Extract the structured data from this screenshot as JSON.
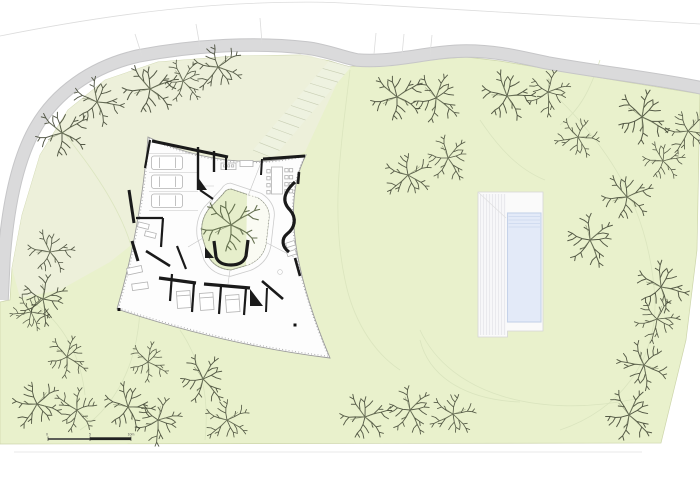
{
  "document": {
    "kind": "site-plan"
  },
  "colors": {
    "background": "#ffffff",
    "site_green": "#e9f1cc",
    "site_green_alt": "#edf0dc",
    "site_edge": "#cdd5ab",
    "courtyard_green": "#e6eecb",
    "road_gray": "#dadadb",
    "road_edge": "#c6c6c8",
    "parcel_line": "#dcdcdc",
    "contour": "#d9e3bd",
    "wall_black": "#1a1a1a",
    "house_outline": "#9b9b9b",
    "furniture_gray": "#b3b3b3",
    "pool_water": "#e3eaf8",
    "pool_edge": "#c5d2e9",
    "pool_steps": "#cbd7ee",
    "deck_white": "#fafafa",
    "deck_line": "#e4e4e9",
    "tree_dark": "#454a38",
    "tree_twig": "#767e60",
    "tree_courtyard": "#5f6b49",
    "scalebar_dark": "#2e2e2e",
    "scalebar_label": "#555555"
  },
  "scale_bar": {
    "labels": [
      "0",
      "5",
      "10m"
    ]
  },
  "trees": {
    "site": [
      {
        "x": 62,
        "y": 133,
        "r": 0,
        "s": 1.15
      },
      {
        "x": 97,
        "y": 102,
        "r": 40,
        "s": 1.1
      },
      {
        "x": 150,
        "y": 89,
        "r": 10,
        "s": 1.2
      },
      {
        "x": 183,
        "y": 81,
        "r": 80,
        "s": 0.95
      },
      {
        "x": 218,
        "y": 67,
        "r": 160,
        "s": 1.1
      },
      {
        "x": 397,
        "y": 97,
        "r": 0,
        "s": 1.15
      },
      {
        "x": 436,
        "y": 98,
        "r": 70,
        "s": 1.1
      },
      {
        "x": 507,
        "y": 96,
        "r": 30,
        "s": 1.15
      },
      {
        "x": 548,
        "y": 92,
        "r": 120,
        "s": 1.0
      },
      {
        "x": 578,
        "y": 137,
        "r": 200,
        "s": 0.95
      },
      {
        "x": 642,
        "y": 117,
        "r": 60,
        "s": 1.2
      },
      {
        "x": 688,
        "y": 131,
        "r": 150,
        "s": 1.0
      },
      {
        "x": 663,
        "y": 161,
        "r": 20,
        "s": 0.9
      },
      {
        "x": 448,
        "y": 158,
        "r": 90,
        "s": 1.0
      },
      {
        "x": 408,
        "y": 175,
        "r": 170,
        "s": 1.05
      },
      {
        "x": 627,
        "y": 197,
        "r": 10,
        "s": 1.1
      },
      {
        "x": 590,
        "y": 240,
        "r": 100,
        "s": 1.15
      },
      {
        "x": 661,
        "y": 287,
        "r": 45,
        "s": 1.15
      },
      {
        "x": 657,
        "y": 319,
        "r": 135,
        "s": 1.0
      },
      {
        "x": 644,
        "y": 365,
        "r": 220,
        "s": 1.1
      },
      {
        "x": 629,
        "y": 415,
        "r": 75,
        "s": 1.15
      },
      {
        "x": 365,
        "y": 417,
        "r": 15,
        "s": 1.1
      },
      {
        "x": 410,
        "y": 410,
        "r": 95,
        "s": 1.05
      },
      {
        "x": 453,
        "y": 414,
        "r": 185,
        "s": 1.0
      },
      {
        "x": 50,
        "y": 252,
        "r": 25,
        "s": 1.0
      },
      {
        "x": 43,
        "y": 299,
        "r": 115,
        "s": 1.1
      },
      {
        "x": 31,
        "y": 312,
        "r": 205,
        "s": 0.85
      },
      {
        "x": 67,
        "y": 357,
        "r": 65,
        "s": 0.95
      },
      {
        "x": 37,
        "y": 404,
        "r": 155,
        "s": 1.1
      },
      {
        "x": 77,
        "y": 410,
        "r": 245,
        "s": 1.0
      },
      {
        "x": 128,
        "y": 407,
        "r": 35,
        "s": 1.1
      },
      {
        "x": 158,
        "y": 420,
        "r": 125,
        "s": 1.05
      },
      {
        "x": 203,
        "y": 379,
        "r": 80,
        "s": 1.1
      },
      {
        "x": 227,
        "y": 420,
        "r": 170,
        "s": 1.0
      },
      {
        "x": 148,
        "y": 362,
        "r": 60,
        "s": 0.9
      }
    ],
    "courtyard": [
      {
        "x": 231,
        "y": 225,
        "r": 0,
        "s": 1.3
      }
    ]
  }
}
